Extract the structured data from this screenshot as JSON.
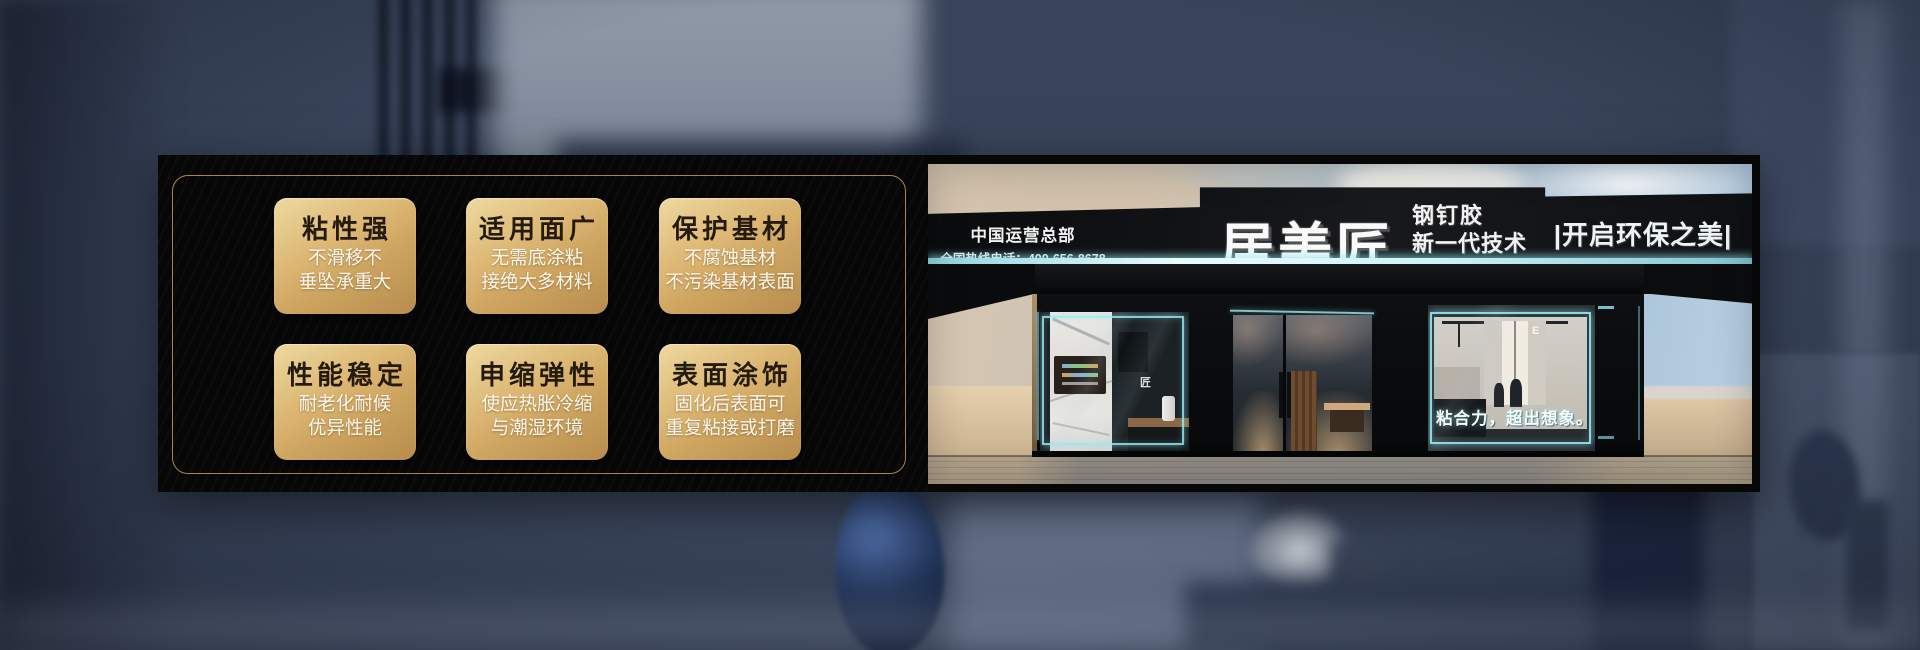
{
  "features": {
    "cards": [
      {
        "title": "粘性强",
        "line1": "不滑移不",
        "line2": "垂坠承重大"
      },
      {
        "title": "适用面广",
        "line1": "无需底涂粘",
        "line2": "接绝大多材料"
      },
      {
        "title": "保护基材",
        "line1": "不腐蚀基材",
        "line2": "不污染基材表面"
      },
      {
        "title": "性能稳定",
        "line1": "耐老化耐候",
        "line2": "优异性能"
      },
      {
        "title": "申缩弹性",
        "line1": "使应热胀冷缩",
        "line2": "与潮湿环境"
      },
      {
        "title": "表面涂饰",
        "line1": "固化后表面可",
        "line2": "重复粘接或打磨"
      }
    ]
  },
  "storefront": {
    "hq": "中国运营总部",
    "hotline": "全国热线电话：400-656-8678",
    "brand": "居美匠",
    "product": "钢钉胶",
    "tagline": "新一代技术",
    "slogan": "|开启环保之美|",
    "window_slogan": "粘合力，超出想象。",
    "glass_decal": "匠",
    "interior_letter": "E"
  },
  "colors": {
    "gold_light": "#eed9a1",
    "gold_dark": "#b78c4e",
    "gold_border": "#a9854f",
    "card_title": "#241a0f",
    "cyan_glow": "#9ae8ee",
    "banner_black": "#070708",
    "background_slate": "#5c6982"
  }
}
